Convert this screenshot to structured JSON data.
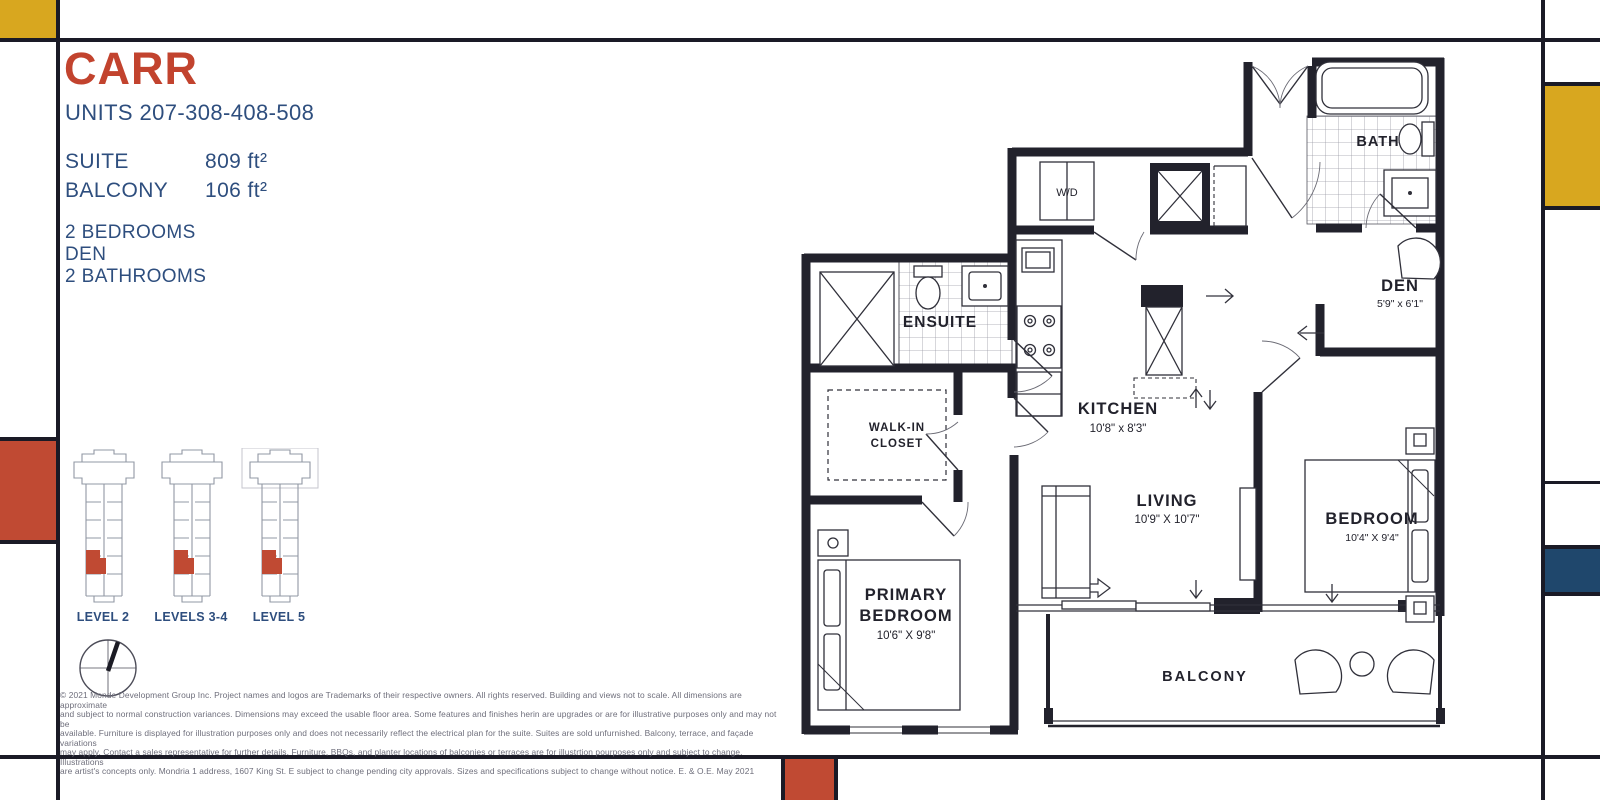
{
  "header": {
    "title": "CARR",
    "units": "UNITS 207-308-408-508"
  },
  "stats": {
    "rows": [
      {
        "label": "SUITE",
        "value": "809 ft²"
      },
      {
        "label": "BALCONY",
        "value": "106 ft²"
      }
    ]
  },
  "features": [
    "2 BEDROOMS",
    "DEN",
    "2 BATHROOMS"
  ],
  "keyplans": {
    "levels": [
      {
        "label": "LEVEL 2"
      },
      {
        "label": "LEVELS 3-4"
      },
      {
        "label": "LEVEL 5"
      }
    ]
  },
  "floorplan": {
    "bath": {
      "name": "BATH"
    },
    "wd": {
      "name": "W/D"
    },
    "ensuite": {
      "name": "ENSUITE"
    },
    "den": {
      "name": "DEN",
      "dims": "5'9\" x 6'1\""
    },
    "walkin": {
      "line1": "WALK-IN",
      "line2": "CLOSET"
    },
    "kitchen": {
      "name": "KITCHEN",
      "dims": "10'8\" x 8'3\""
    },
    "living": {
      "name": "LIVING",
      "dims": "10'9\" X 10'7\""
    },
    "primary": {
      "line1": "PRIMARY",
      "line2": "BEDROOM",
      "dims": "10'6\" X 9'8\""
    },
    "bedroom": {
      "name": "BEDROOM",
      "dims": "10'4\" X 9'4\""
    },
    "balcony": {
      "name": "BALCONY"
    }
  },
  "disclaimer": {
    "lines": [
      "© 2021 Monde Development Group Inc.  Project names and logos are Trademarks of their respective owners.  All rights reserved.  Building and views not to scale.  All dimensions are approximate",
      "and subject to normal construction variances.  Dimensions may exceed the usable floor area.  Some features and finishes herin are upgrades or are for illustrative purposes only and may not be",
      "available.  Furniture is displayed for illustration purposes only and does not necessarily reflect the electrical plan for the suite.  Suites are sold unfurnished.  Balcony, terrace, and façade variations",
      "may apply.  Contact a sales representative for further details.  Furniture, BBQs, and planter locations of balconies or terraces are for illustrtion pourposes only and subject to change.  Illustrations",
      "are artist's concepts only.  Mondria 1 address, 1607 King St. E subject to change pending city approvals.  Sizes and specifications subject to change without notice. E. & O.E. May 2021"
    ]
  },
  "colors": {
    "accent_red": "#C2432E",
    "text_blue": "#2E4E7E",
    "mondrian_yellow": "#D8A71F",
    "mondrian_red": "#C04A33",
    "mondrian_blue": "#1F476C",
    "frame_line": "#1A1A26",
    "wall_black": "#22222C"
  }
}
